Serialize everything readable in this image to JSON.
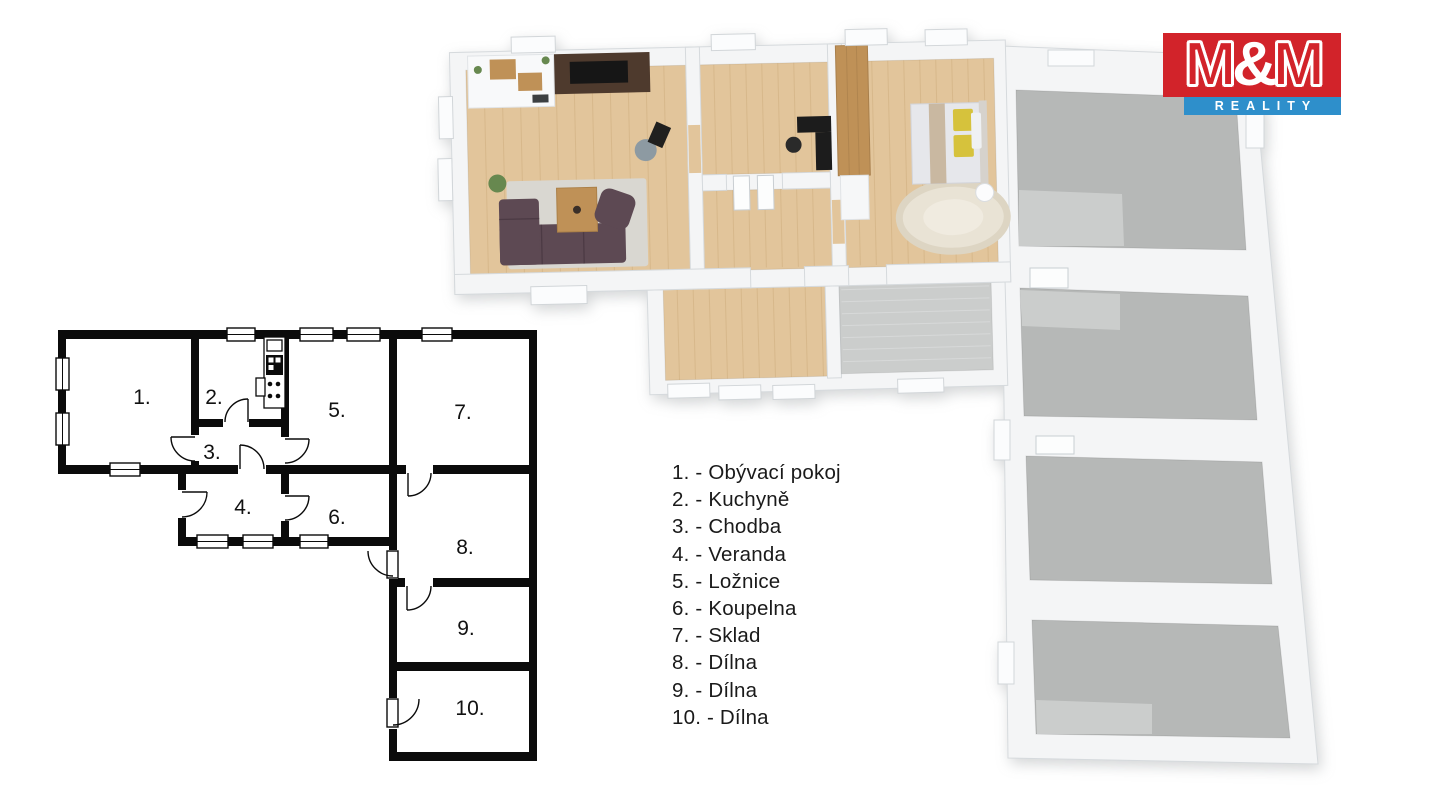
{
  "brand": {
    "m_left": "M",
    "ampersand": "&",
    "m_right": "M",
    "subtitle": "REALITY"
  },
  "rooms": [
    {
      "plan_label": "1.",
      "name": "Obývací pokoj",
      "legend": "1. - Obývací pokoj"
    },
    {
      "plan_label": "2.",
      "name": "Kuchyně",
      "legend": "2. - Kuchyně"
    },
    {
      "plan_label": "3.",
      "name": "Chodba",
      "legend": "3. - Chodba"
    },
    {
      "plan_label": "4.",
      "name": "Veranda",
      "legend": "4. - Veranda"
    },
    {
      "plan_label": "5.",
      "name": "Ložnice",
      "legend": "5. - Ložnice"
    },
    {
      "plan_label": "6.",
      "name": "Koupelna",
      "legend": "6. - Koupelna"
    },
    {
      "plan_label": "7.",
      "name": "Sklad",
      "legend": "7. - Sklad"
    },
    {
      "plan_label": "8.",
      "name": "Dílna",
      "legend": "8. - Dílna"
    },
    {
      "plan_label": "9.",
      "name": "Dílna",
      "legend": "9. - Dílna"
    },
    {
      "plan_label": "10.",
      "name": "Dílna",
      "legend": "10. - Dílna"
    }
  ],
  "palette": {
    "logo_red": "#d2232a",
    "logo_blue": "#2e8fcb",
    "ink": "#0b0b0b",
    "text": "#1a1a1a",
    "wall": "#f4f5f6",
    "wall_edge": "#d6dadd",
    "wood": "#e2c59b",
    "wood_line": "#c9a878",
    "gray_floor": "#b6b8b7",
    "gray_light": "#cdcfce",
    "tile": "#cbcdcc",
    "sofa": "#5d4953",
    "media_wall": "#4e3a2d",
    "cabinet_wood": "#bf9157",
    "rug": "#d9d7d1",
    "bed_rug": "#e9e3d5",
    "pillow": "#d6c23c",
    "plant": "#67884f",
    "tv": "#161616"
  }
}
